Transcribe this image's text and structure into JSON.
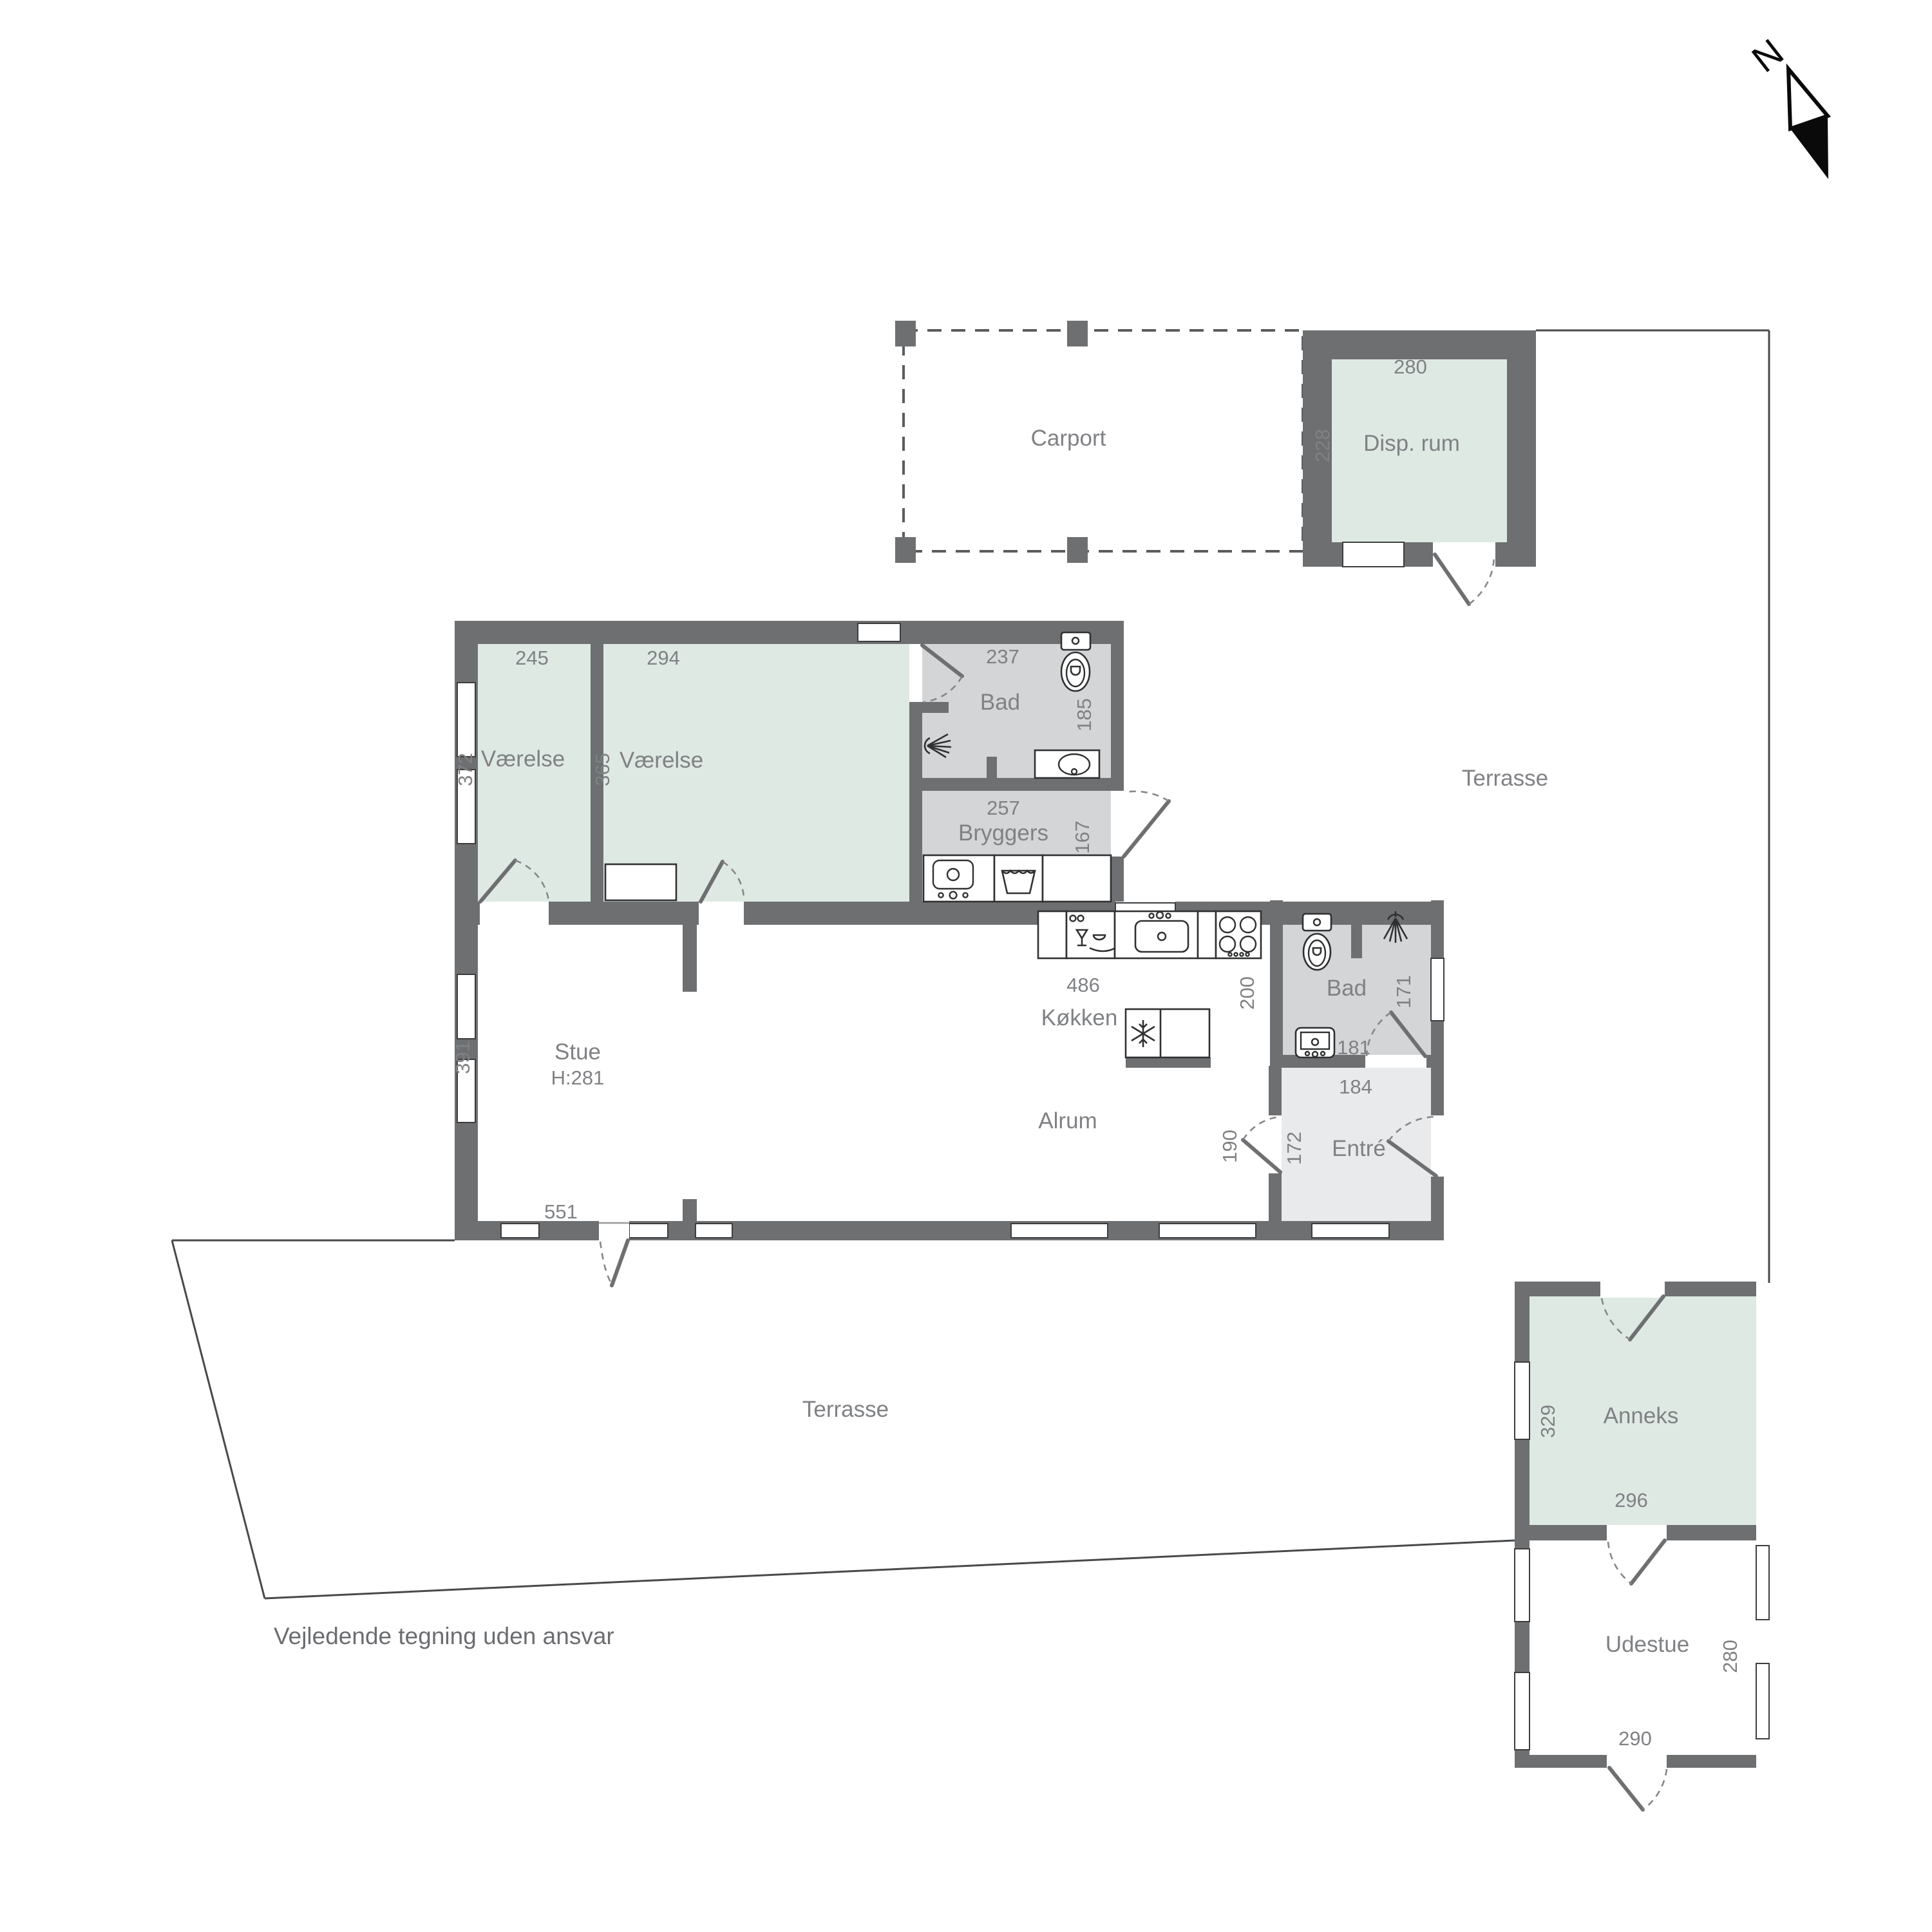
{
  "compass": {
    "label": "N"
  },
  "note": "Vejledende tegning uden ansvar",
  "areas": {
    "carport": "Carport",
    "terrasse_upper": "Terrasse",
    "terrasse_lower": "Terrasse"
  },
  "rooms": {
    "disp_rum": {
      "name": "Disp. rum",
      "w": "280",
      "h": "228"
    },
    "vaerelse_1": {
      "name": "Værelse",
      "w": "245",
      "h": "372"
    },
    "vaerelse_2": {
      "name": "Værelse",
      "w": "294",
      "h": "365"
    },
    "bad_1": {
      "name": "Bad",
      "w": "237",
      "h": "185"
    },
    "bryggers": {
      "name": "Bryggers",
      "w": "257",
      "h": "167"
    },
    "stue": {
      "name": "Stue",
      "ceiling": "H:281",
      "h": "391",
      "w": "551"
    },
    "kokken": {
      "name": "Køkken",
      "w": "486",
      "d": "200"
    },
    "alrum": {
      "name": "Alrum"
    },
    "bad_2": {
      "name": "Bad",
      "h": "171",
      "sink": "181",
      "s": "184"
    },
    "entre": {
      "name": "Entré",
      "w": "172",
      "o": "190"
    },
    "anneks": {
      "name": "Anneks",
      "h": "329",
      "w": "296"
    },
    "udestue": {
      "name": "Udestue",
      "h": "280",
      "w": "290"
    }
  }
}
